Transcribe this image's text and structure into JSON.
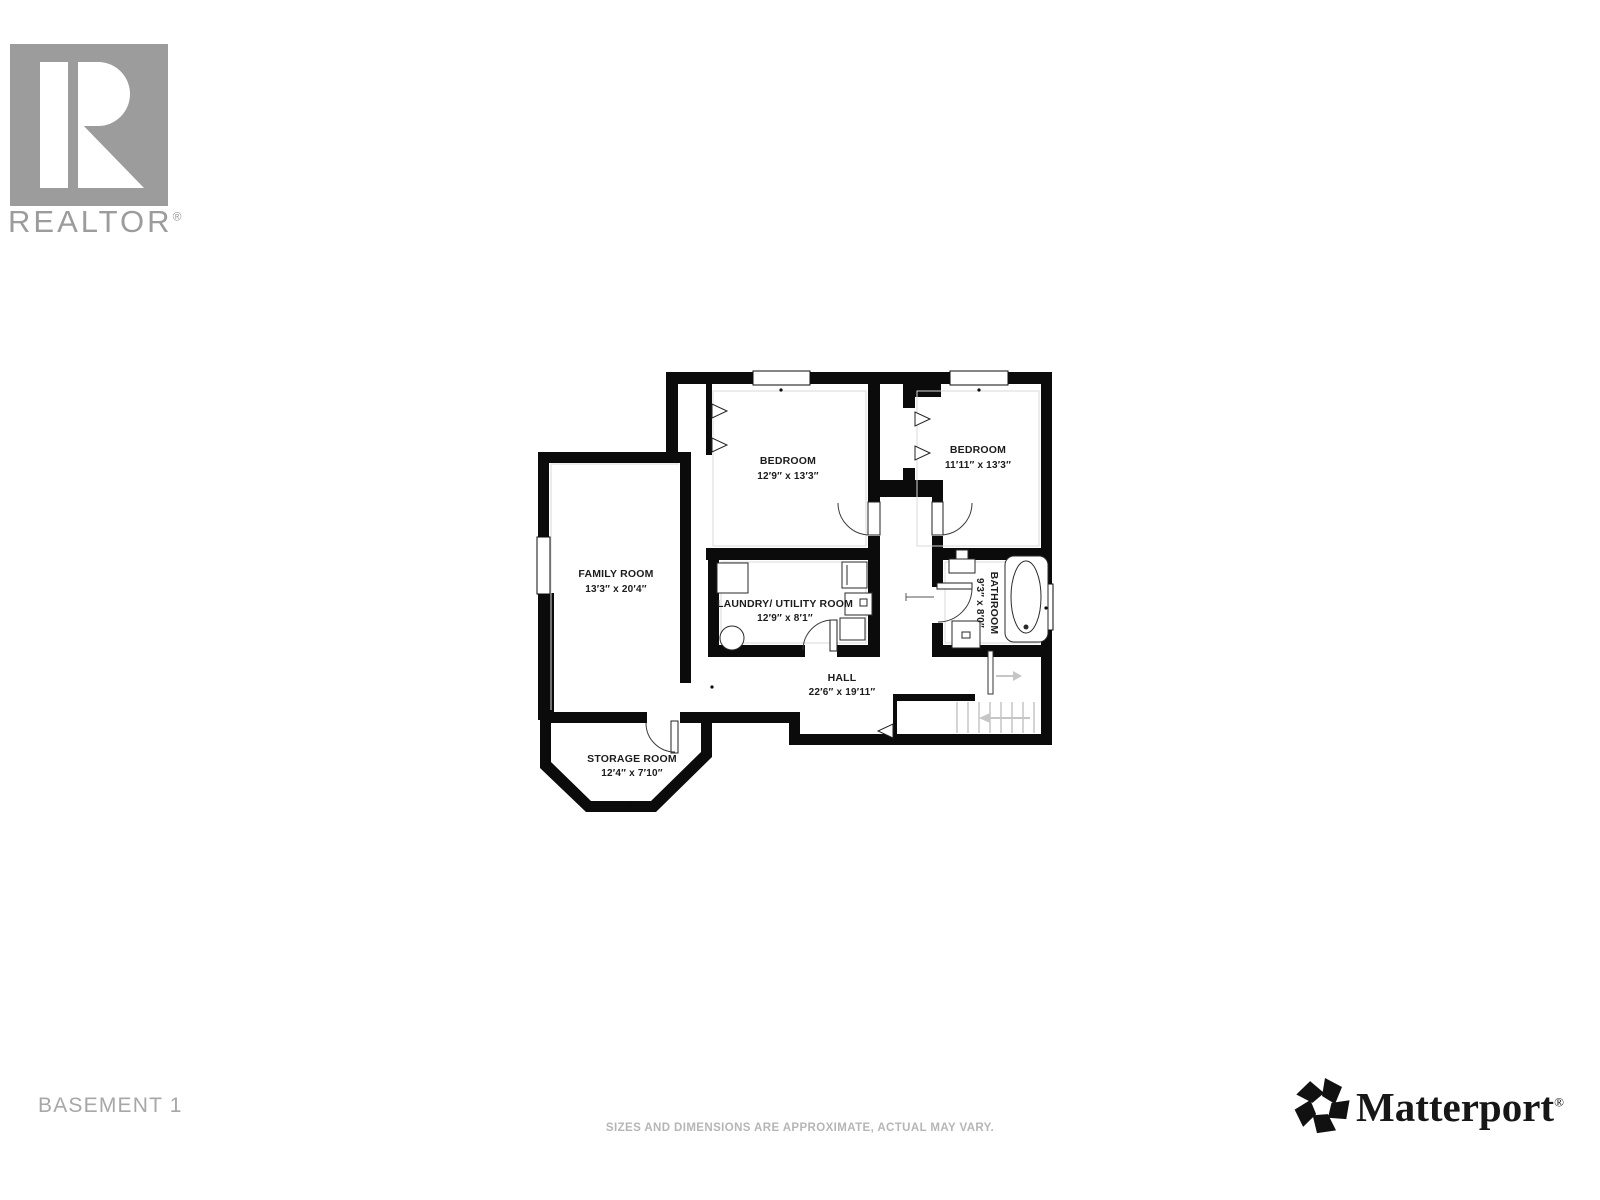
{
  "branding": {
    "realtor_wordmark": "REALTOR",
    "realtor_reg": "®",
    "matterport_wordmark": "Matterport",
    "matterport_reg": "®"
  },
  "footer": {
    "floor_label": "BASEMENT 1",
    "disclaimer": "SIZES AND DIMENSIONS ARE APPROXIMATE, ACTUAL MAY VARY."
  },
  "floorplan": {
    "rooms": [
      {
        "id": "bedroom-1",
        "name": "BEDROOM",
        "dims": "12′9″ x 13′3″"
      },
      {
        "id": "bedroom-2",
        "name": "BEDROOM",
        "dims": "11′11″ x 13′3″"
      },
      {
        "id": "family-room",
        "name": "FAMILY ROOM",
        "dims": "13′3″ x 20′4″"
      },
      {
        "id": "laundry-utility-room",
        "name": "LAUNDRY/ UTILITY ROOM",
        "dims": "12′9″ x 8′1″"
      },
      {
        "id": "bathroom",
        "name": "BATHROOM",
        "dims": "9′3″ x 8′0″"
      },
      {
        "id": "hall",
        "name": "HALL",
        "dims": "22′6″ x 19′11″"
      },
      {
        "id": "storage-room",
        "name": "STORAGE ROOM",
        "dims": "12′4″ x 7′10″"
      }
    ],
    "colors": {
      "wall": "#0b0b0b",
      "label": "#1c1c1c",
      "logo_gray": "#9c9c9c",
      "arrow_gray": "#c6c6c6",
      "background": "#ffffff"
    }
  }
}
